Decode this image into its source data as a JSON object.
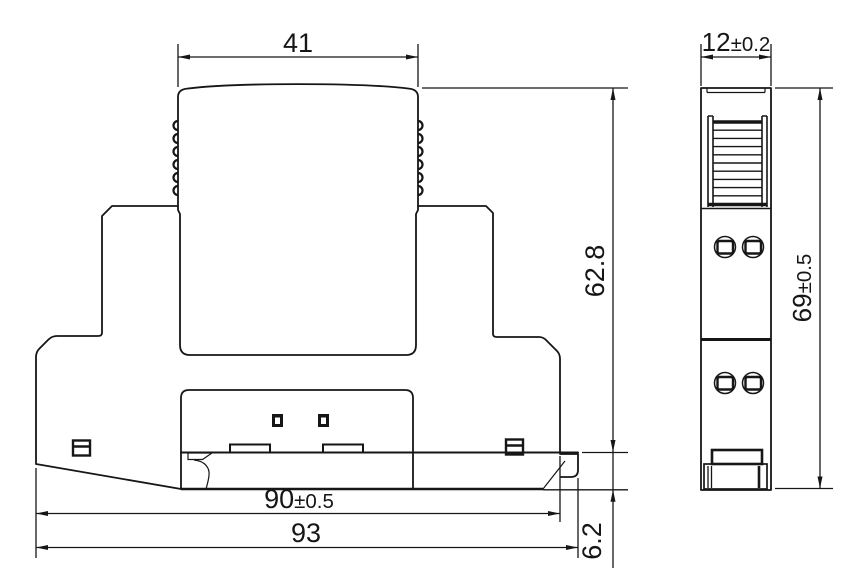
{
  "drawing_type": "technical-dimension-drawing",
  "views": {
    "front": {
      "dims": {
        "top_width": {
          "value": "41",
          "tolerance": ""
        },
        "body_height": {
          "value": "62.8",
          "tolerance": ""
        },
        "rail_width": {
          "value": "90",
          "tolerance": "±0.5"
        },
        "overall_width": {
          "value": "93",
          "tolerance": ""
        },
        "foot_height": {
          "value": "6.2",
          "tolerance": ""
        }
      }
    },
    "side": {
      "dims": {
        "width": {
          "value": "12",
          "tolerance": "±0.2"
        },
        "height": {
          "value": "69",
          "tolerance": "±0.5"
        }
      }
    }
  },
  "colors": {
    "line": "#161616",
    "background": "#ffffff"
  }
}
